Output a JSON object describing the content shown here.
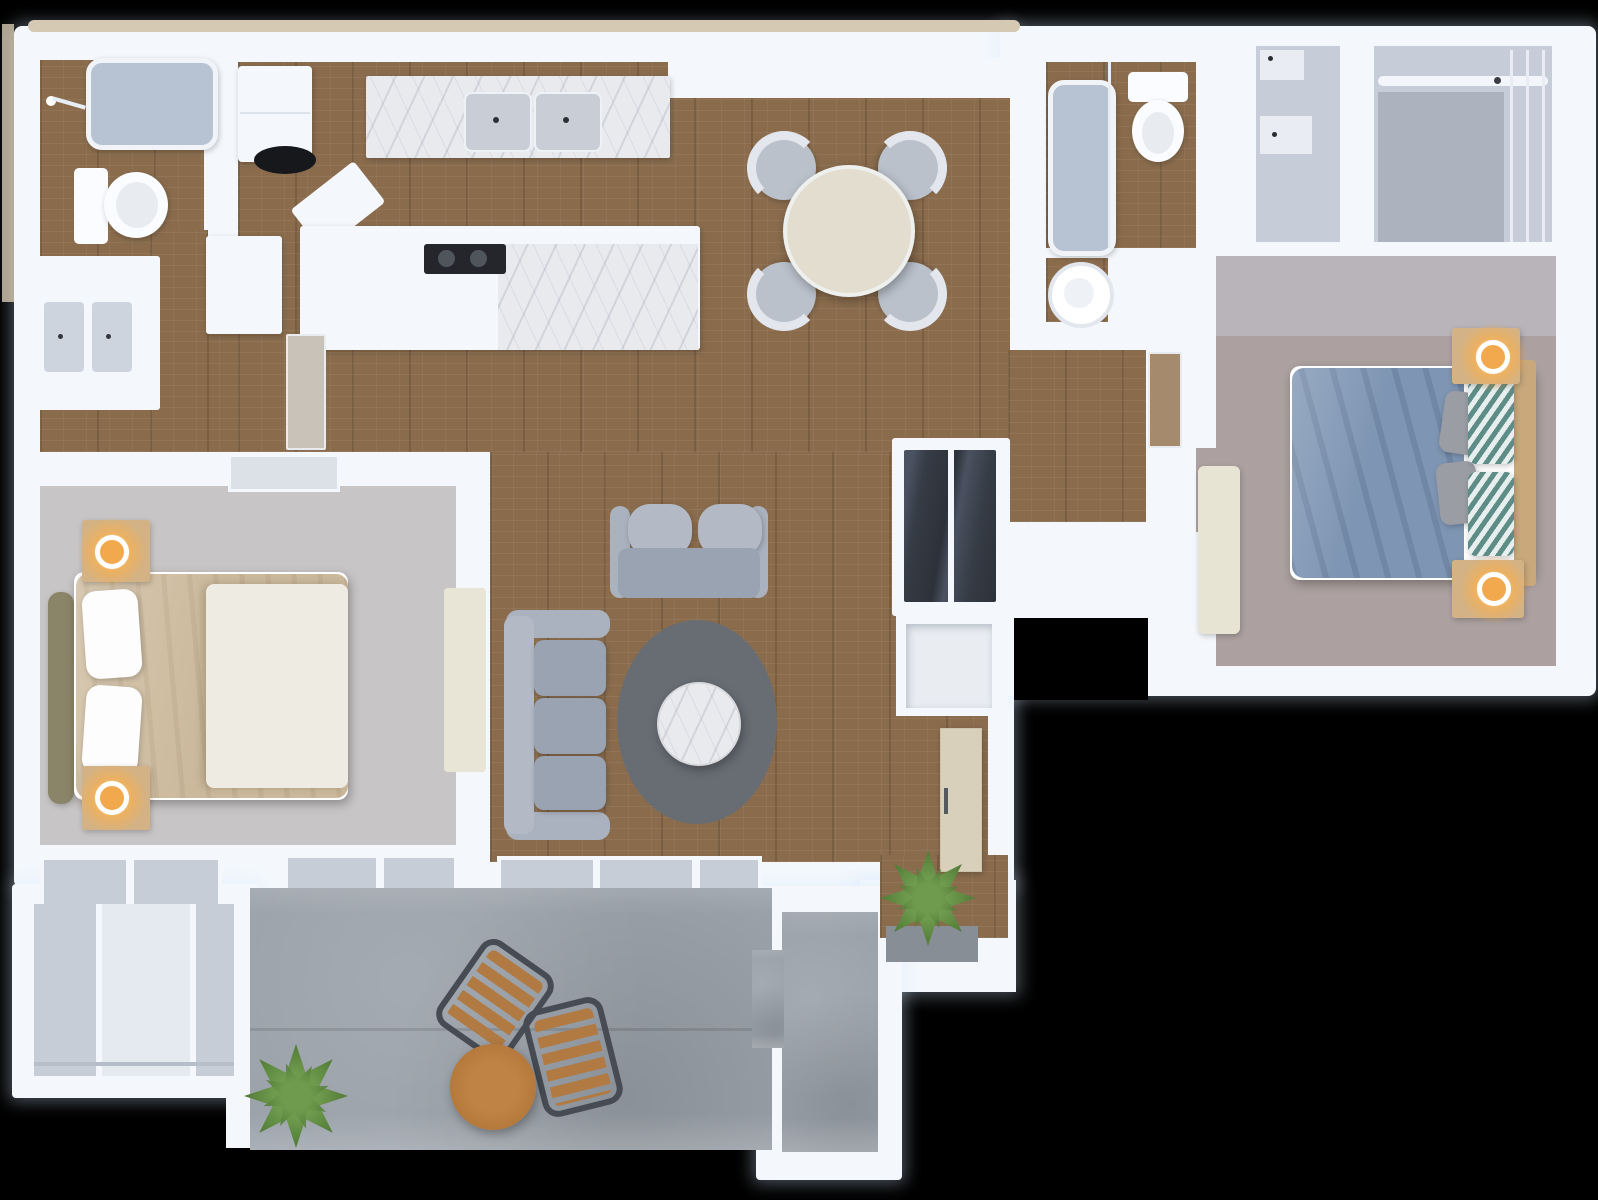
{
  "palette": {
    "bg": "#000000",
    "wall": "#f4f8fc",
    "wallEdge": "#d6c9b4",
    "wood": "#8a6c4d",
    "concrete": "#9aa1a9",
    "marble": "#e9eaee",
    "carpetMaster": "#c8c5c6",
    "carpetGuest": "#aca1a0",
    "carpetCloset": "#c6ccd8",
    "tub": "#b7c3d3",
    "glass": "#c6cdd6",
    "darkGlass": "#363c45",
    "sofa": "#9aa3b2",
    "sofaLight": "#b3bac6",
    "rug": "#686d74",
    "diningTable": "#e3ddd0",
    "diningChair": "#bac1cb",
    "duvetBlue": "#7e95b3",
    "duvetTan": "#ccb99c",
    "blanket": "#edebe2",
    "pillowGray": "#9b9da5",
    "pillowTeal": "#5d8d86",
    "headboardOlive": "#8a8468",
    "woodFurn": "#d3b285",
    "lampGlow": "#ffb55e",
    "patioTable": "#b5793c",
    "chairSlat": "#b07a42",
    "chairFrame": "#474c54",
    "plant": "#4a732f",
    "plantLight": "#6f9b4f",
    "fixture": "#fafcff",
    "cooktop": "#24262b",
    "steel": "#c9ced6",
    "cabinetBeige": "#d9d0bc",
    "doorWood": "#a58a6d",
    "niche": "#e9edf2"
  },
  "scene": {
    "type": "3d-floor-plan-top-view",
    "rooms": [
      {
        "name": "bathroom-1",
        "furniture": [
          "bathtub",
          "shower-fixture",
          "toilet",
          "double-vanity-sink"
        ]
      },
      {
        "name": "kitchen",
        "furniture": [
          "refrigerator",
          "marble-counter-double-sink",
          "cooktop-peninsula",
          "water-heater"
        ]
      },
      {
        "name": "dining-area",
        "furniture": [
          "round-dining-table",
          "dining-chair",
          "dining-chair",
          "dining-chair",
          "dining-chair"
        ]
      },
      {
        "name": "living-room",
        "furniture": [
          "loveseat",
          "sofa",
          "oval-area-rug",
          "round-marble-coffee-table",
          "potted-plant",
          "mirrored-entry-closet",
          "beige-cabinet"
        ]
      },
      {
        "name": "master-bedroom",
        "furniture": [
          "double-bed",
          "tufted-headboard",
          "nightstand-with-lamp",
          "nightstand-with-lamp",
          "dresser",
          "sliding-door-closet"
        ]
      },
      {
        "name": "bathroom-2",
        "furniture": [
          "bathtub-shower",
          "toilet",
          "water-heater",
          "vanity"
        ]
      },
      {
        "name": "walk-in-closets",
        "furniture": [
          "shelf-closet",
          "hanging-rod-closet"
        ]
      },
      {
        "name": "guest-bedroom",
        "furniture": [
          "double-bed-blue-duvet",
          "chevron-pillows",
          "nightstand-with-lamp",
          "nightstand-with-lamp",
          "bench"
        ]
      },
      {
        "name": "patio",
        "furniture": [
          "slat-lounge-chair",
          "slat-lounge-chair",
          "round-wood-table",
          "potted-plant",
          "storage-room"
        ]
      }
    ]
  }
}
